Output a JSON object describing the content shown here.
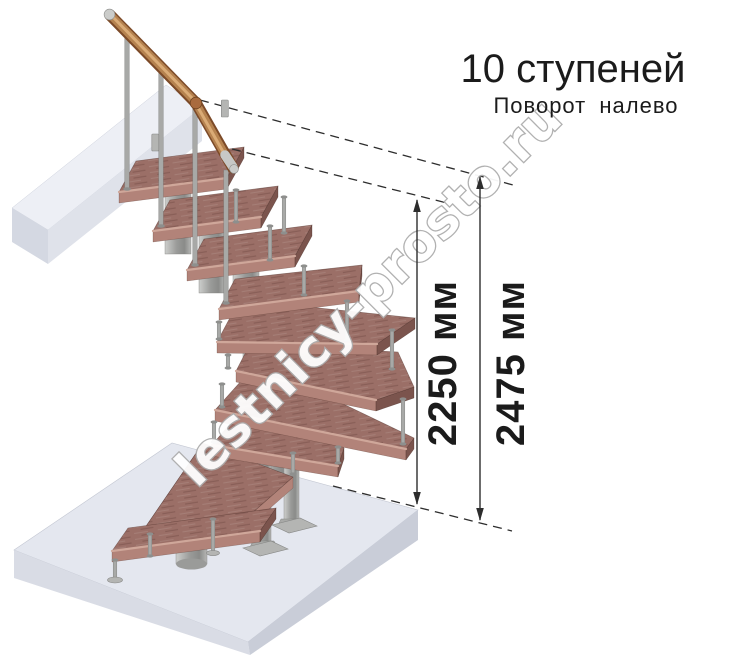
{
  "header": {
    "title": "10 ступеней",
    "subtitle": "Поворот налево"
  },
  "dimensions": {
    "inner": {
      "label": "2250 мм",
      "value_mm": 2250
    },
    "outer": {
      "label": "2475 мм",
      "value_mm": 2475
    }
  },
  "watermark": {
    "text": "lestnicy-prosto.ru"
  },
  "stair": {
    "steps_count": 10,
    "turn_direction": "налево"
  },
  "colors": {
    "background": "#ffffff",
    "wood_top": "#9b6f67",
    "wood_front": "#b28379",
    "wood_side": "#7b544d",
    "wood_nose": "#cfa79a",
    "metal": "#a8a9a7",
    "metal_dark": "#7f807e",
    "column_light": "#cdcecc",
    "column_dark": "#8a8b89",
    "handrail": "#b5824f",
    "handrail_dark": "#7c4a28",
    "handrail_light": "#daab76",
    "floor_top": "#e4e7ef",
    "floor_left": "#d9dce5",
    "floor_right": "#c9cdd8",
    "slab_top": "#edeff5",
    "slab_front": "#dfe2ea",
    "slab_end": "#d4d8e2",
    "dimension": "#2d2d2d",
    "text": "#1b1b1b",
    "watermark_outline": "#adadad"
  }
}
